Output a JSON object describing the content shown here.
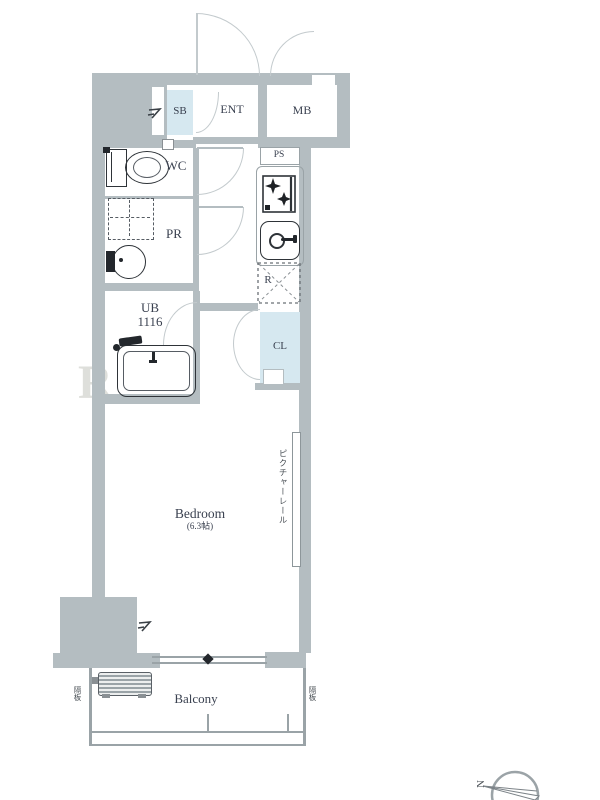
{
  "meta": {
    "type": "apartment-floor-plan"
  },
  "labels": {
    "sb": "SB",
    "ent": "ENT",
    "mb": "MB",
    "wc": "WC",
    "pr": "PR",
    "ub": "UB",
    "ub_size": "1116",
    "ps": "PS",
    "r": "R",
    "cl": "CL",
    "bedroom": "Bedroom",
    "bedroom_size": "(6.3帖)",
    "balcony": "Balcony"
  },
  "annotations": {
    "picture_rail": "ピクチャーレール",
    "partition_left": "隔板",
    "partition_right": "隔板",
    "compass_north": "N",
    "watermark": "R"
  },
  "colors": {
    "wall": "#b4bdc1",
    "closet_fill": "#d6e8f0",
    "fixture_line": "#2e3338",
    "door_arc": "#c3cacd",
    "balcony_line": "#9aa3a7"
  }
}
